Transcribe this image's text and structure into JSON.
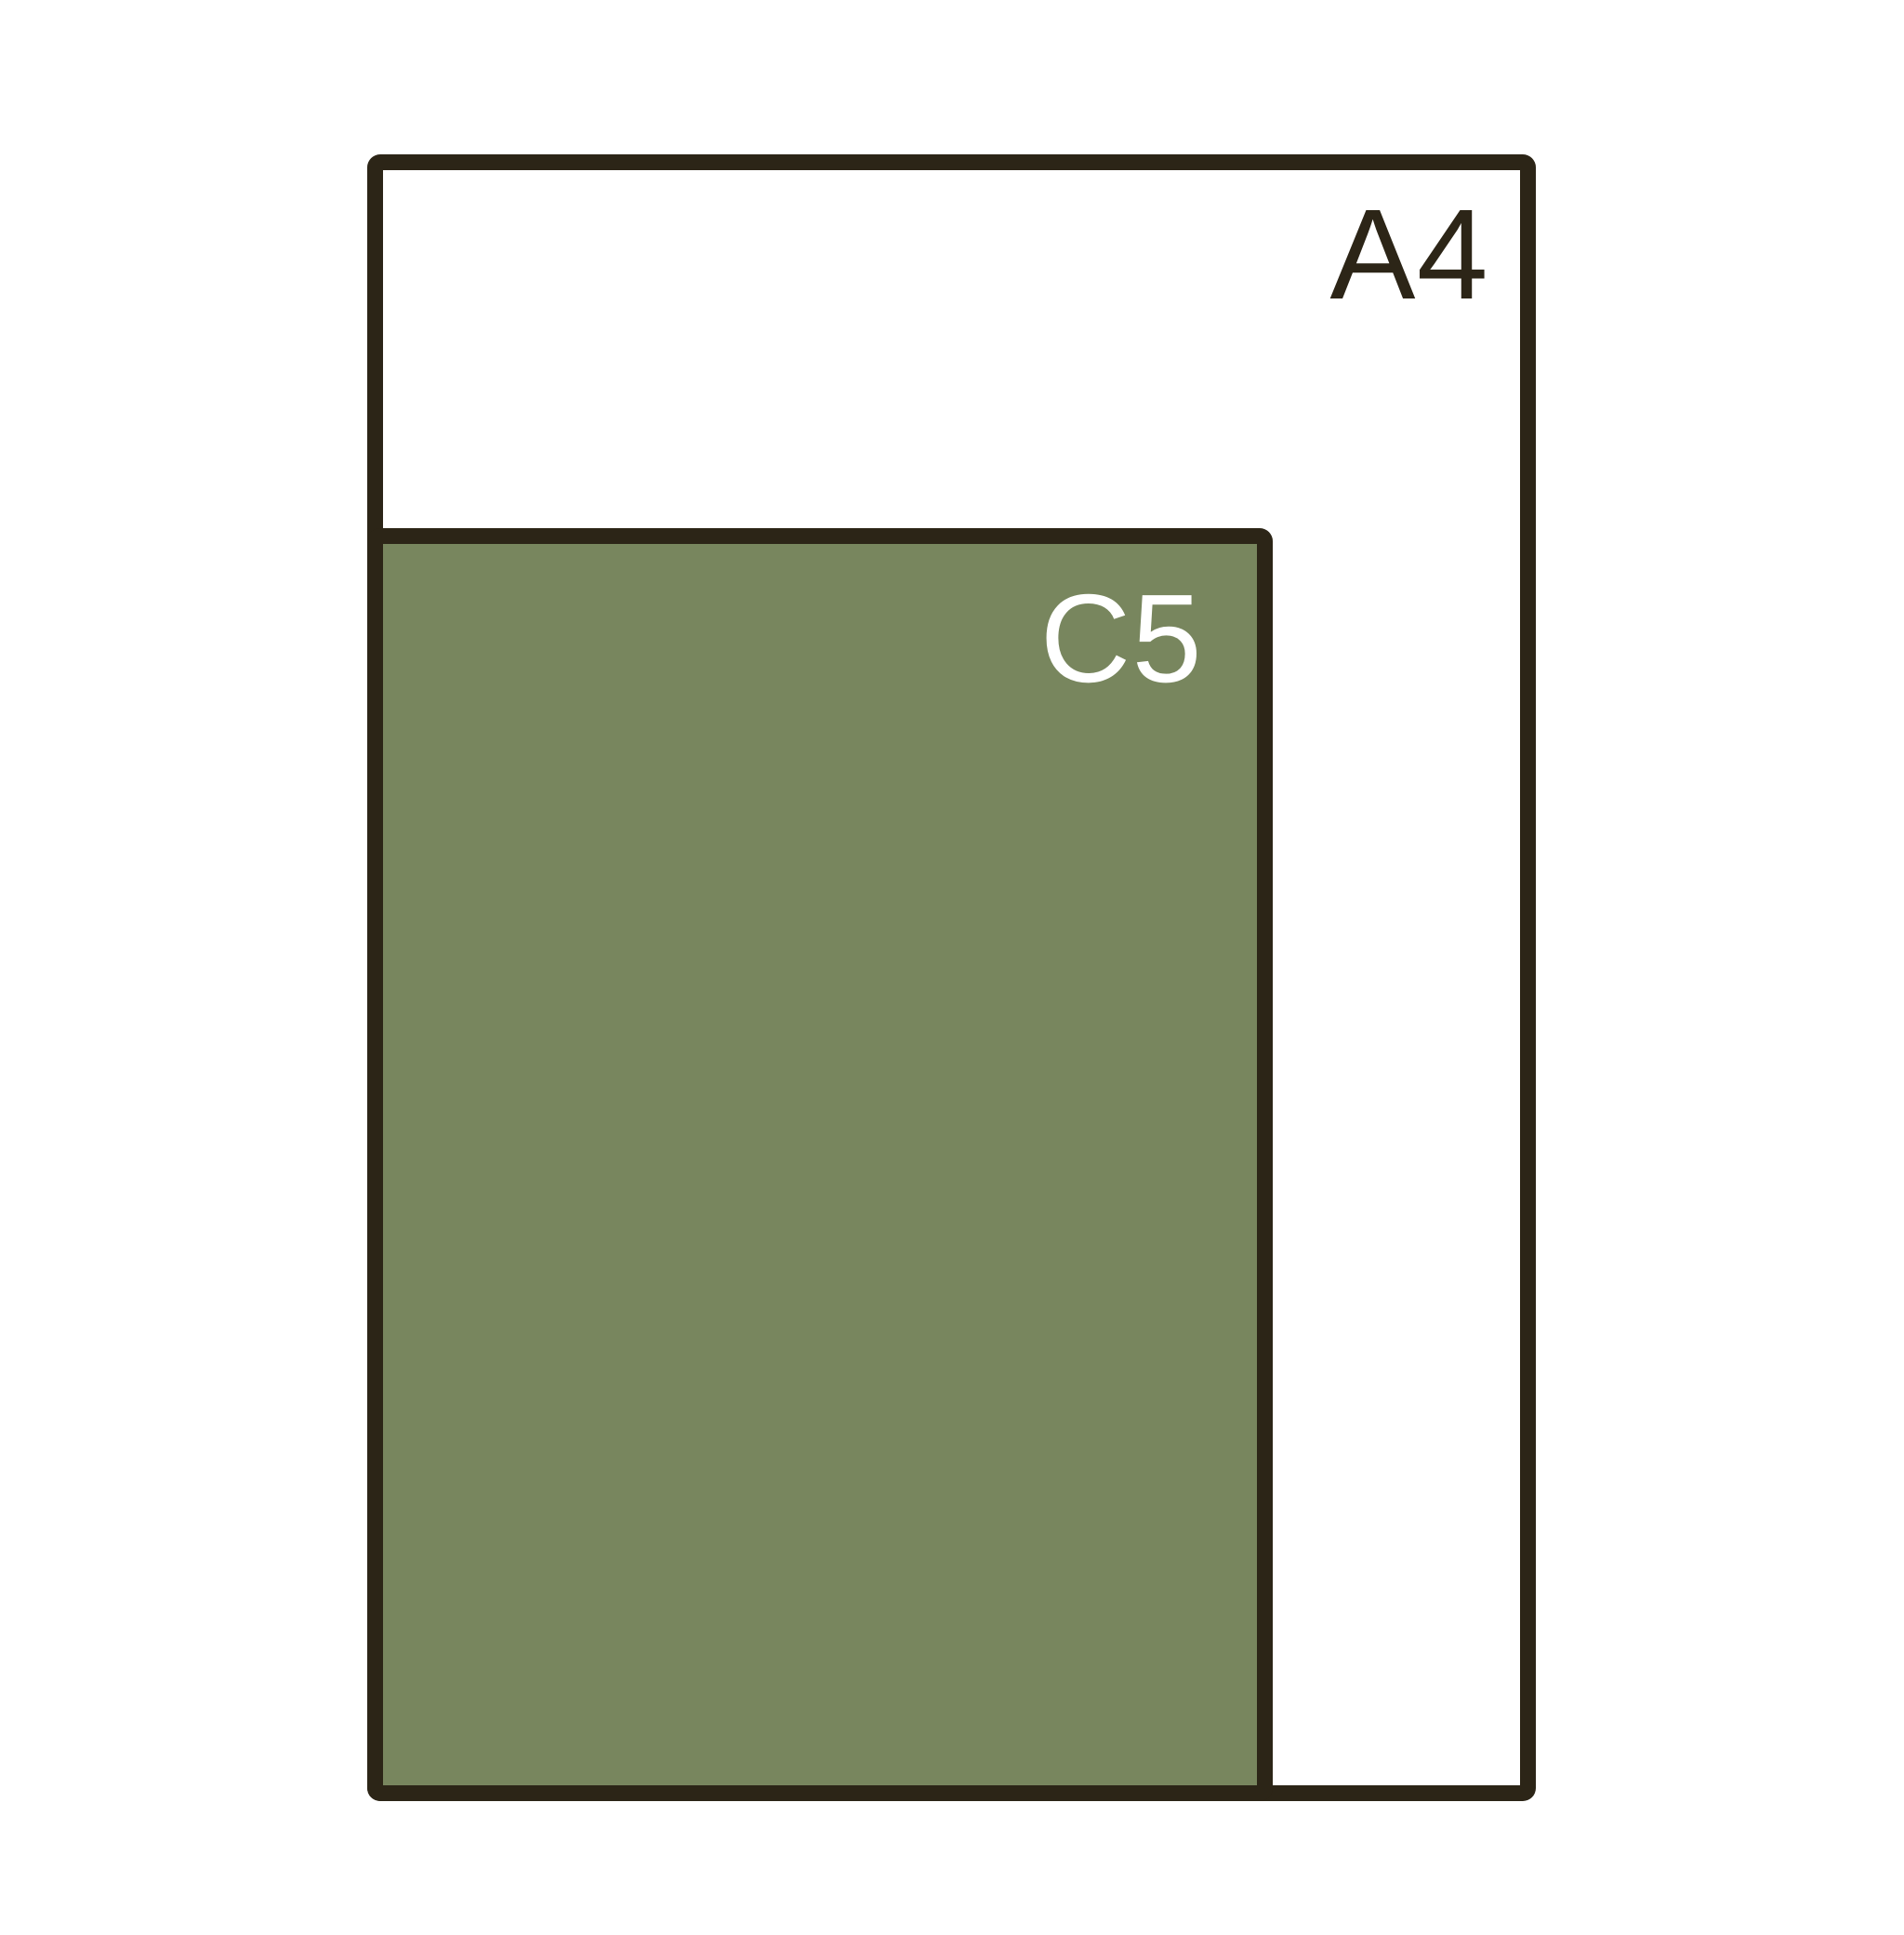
{
  "diagram": {
    "type": "paper-size-comparison",
    "outline_color": "#2c2517",
    "background_color": "#ffffff",
    "sizes": [
      {
        "label": "A4",
        "fill": "#ffffff",
        "label_color": "#2c2517"
      },
      {
        "label": "C5",
        "fill": "#78865e",
        "label_color": "#ffffff"
      }
    ]
  }
}
